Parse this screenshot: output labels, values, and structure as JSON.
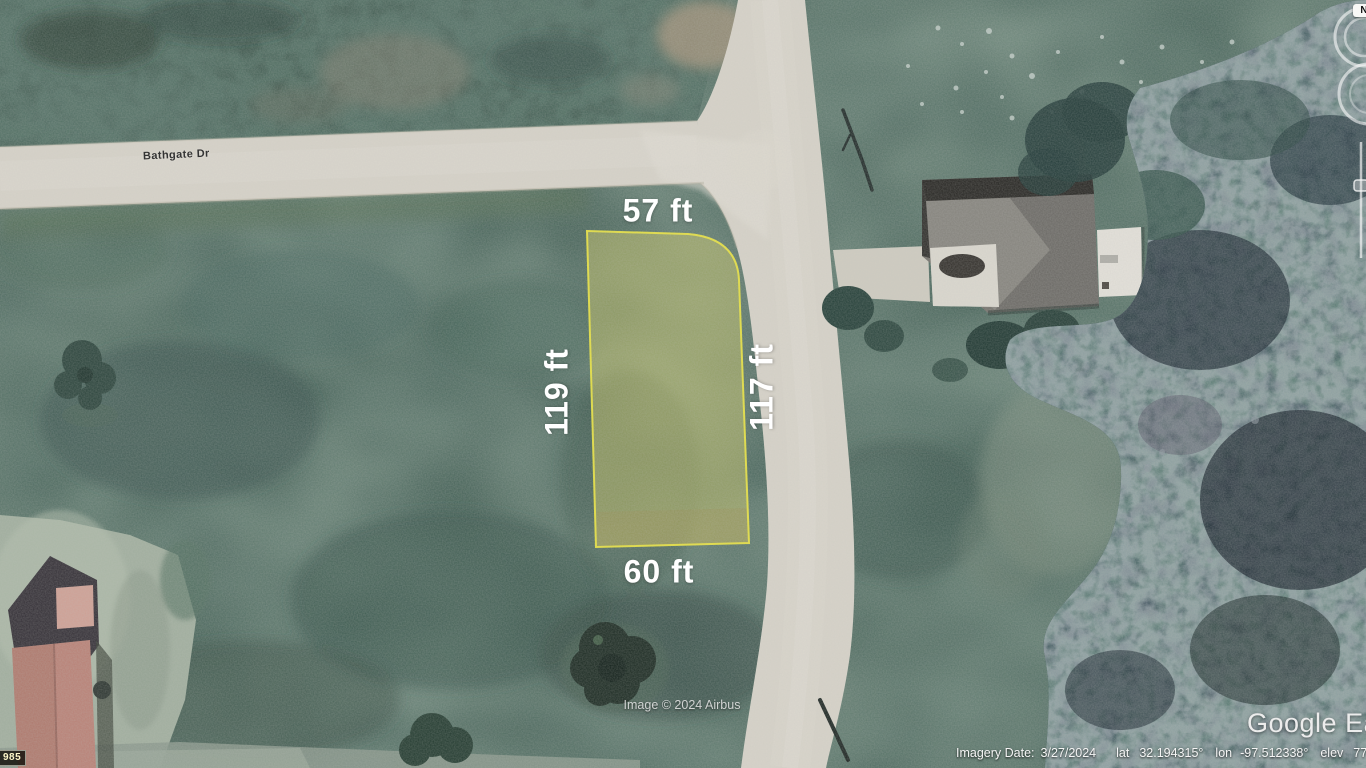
{
  "app": {
    "watermark": "Google Earth",
    "attribution": "Image © 2024 Airbus",
    "corner_badge": "985"
  },
  "map": {
    "street_label": "Bathgate Dr",
    "field_color": "#3d5a50",
    "road_color": "#d7d3c9",
    "forest_color": "#27363d"
  },
  "parcel": {
    "top_dimension": "57 ft",
    "left_dimension": "119 ft",
    "right_dimension": "117 ft",
    "bottom_dimension": "60 ft",
    "fill_color": "#cbc766",
    "outline_color": "#eae43e"
  },
  "nav": {
    "north_label": "N"
  },
  "status_bar": {
    "imagery_date_label": "Imagery Date:",
    "imagery_date": "3/27/2024",
    "lat_label": "lat",
    "lat_value": "32.194315°",
    "lon_label": "lon",
    "lon_value": "-97.512338°",
    "elev_label": "elev",
    "elev_value": "771 ft",
    "eye_alt_label": "eye alt",
    "eye_alt_value": "1267 ft"
  }
}
